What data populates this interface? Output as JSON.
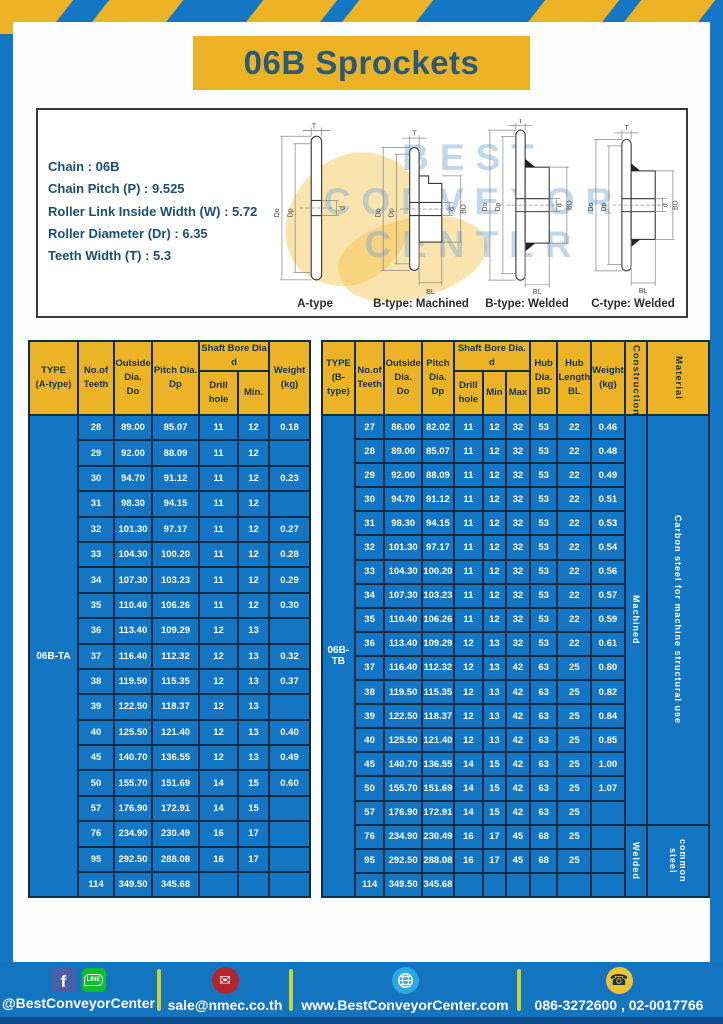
{
  "page": {
    "title": "06B Sprockets"
  },
  "specs": {
    "lines": [
      "Chain : 06B",
      "Chain Pitch (P) : 9.525",
      "Roller Link Inside Width (W) : 5.72",
      "Roller Diameter (Dr) : 6.35",
      "Teeth Width (T) : 5.3"
    ]
  },
  "watermark": {
    "line1": "BEST",
    "line2": "CONVEYOR",
    "line3": "CENTER"
  },
  "diagrams": {
    "figures": [
      {
        "caption": "A-type",
        "labels": {
          "t": "T",
          "do": "Do",
          "dp": "Dp",
          "d": "d"
        }
      },
      {
        "caption": "B-type: Machined",
        "labels": {
          "t": "T",
          "do": "Do",
          "dp": "Dp",
          "d": "d",
          "bd": "BD",
          "bl": "BL"
        }
      },
      {
        "caption": "B-type: Welded",
        "labels": {
          "t": "T",
          "do": "Do",
          "dp": "Dp",
          "d": "d",
          "bd": "BD",
          "bl": "BL"
        }
      },
      {
        "caption": "C-type: Welded",
        "labels": {
          "t": "T",
          "do": "Do",
          "dp": "Dp",
          "d": "d",
          "bd": "BD",
          "bl": "BL"
        }
      }
    ]
  },
  "table_a": {
    "type_label": "06B-TA",
    "headers": {
      "type": "TYPE\n(A-type)",
      "teeth": "No.of\nTeeth",
      "outside": "Outside\nDia.\nDo",
      "pitch": "Pitch Dia.\nDp",
      "shaft_group": "Shaft Bore Dia d",
      "drill": "Drill hole",
      "min": "Min.",
      "weight": "Weight\n(kg)"
    },
    "rows": [
      [
        "28",
        "89.00",
        "85.07",
        "11",
        "12",
        "0.18"
      ],
      [
        "29",
        "92.00",
        "88.09",
        "11",
        "12",
        ""
      ],
      [
        "30",
        "94.70",
        "91.12",
        "11",
        "12",
        "0.23"
      ],
      [
        "31",
        "98.30",
        "94.15",
        "11",
        "12",
        ""
      ],
      [
        "32",
        "101.30",
        "97.17",
        "11",
        "12",
        "0.27"
      ],
      [
        "33",
        "104.30",
        "100.20",
        "11",
        "12",
        "0.28"
      ],
      [
        "34",
        "107.30",
        "103.23",
        "11",
        "12",
        "0.29"
      ],
      [
        "35",
        "110.40",
        "106.26",
        "11",
        "12",
        "0.30"
      ],
      [
        "36",
        "113.40",
        "109.29",
        "12",
        "13",
        ""
      ],
      [
        "37",
        "116.40",
        "112.32",
        "12",
        "13",
        "0.32"
      ],
      [
        "38",
        "119.50",
        "115.35",
        "12",
        "13",
        "0.37"
      ],
      [
        "39",
        "122.50",
        "118.37",
        "12",
        "13",
        ""
      ],
      [
        "40",
        "125.50",
        "121.40",
        "12",
        "13",
        "0.40"
      ],
      [
        "45",
        "140.70",
        "136.55",
        "12",
        "13",
        "0.49"
      ],
      [
        "50",
        "155.70",
        "151.69",
        "14",
        "15",
        "0.60"
      ],
      [
        "57",
        "176.90",
        "172.91",
        "14",
        "15",
        ""
      ],
      [
        "76",
        "234.90",
        "230.49",
        "16",
        "17",
        ""
      ],
      [
        "95",
        "292.50",
        "288.08",
        "16",
        "17",
        ""
      ],
      [
        "114",
        "349.50",
        "345.68",
        "",
        "",
        ""
      ]
    ]
  },
  "table_b": {
    "type_label": "06B-TB",
    "headers": {
      "type": "TYPE\n(B-type)",
      "teeth": "No.of\nTeeth",
      "outside": "Outside\nDia.\nDo",
      "pitch": "Pitch\nDia.\nDp",
      "shaft_group": "Shaft Bore Dia. d",
      "drill": "Drill hole",
      "min": "Min",
      "max": "Max",
      "hub_dia": "Hub\nDia.\nBD",
      "hub_len": "Hub\nLength\nBL",
      "weight": "Weight\n(kg)",
      "construction": "Construction",
      "material": "Material"
    },
    "rows": [
      [
        "27",
        "86.00",
        "82.02",
        "11",
        "12",
        "32",
        "53",
        "22",
        "0.46"
      ],
      [
        "28",
        "89.00",
        "85.07",
        "11",
        "12",
        "32",
        "53",
        "22",
        "0.48"
      ],
      [
        "29",
        "92.00",
        "88.09",
        "11",
        "12",
        "32",
        "53",
        "22",
        "0.49"
      ],
      [
        "30",
        "94.70",
        "91.12",
        "11",
        "12",
        "32",
        "53",
        "22",
        "0.51"
      ],
      [
        "31",
        "98.30",
        "94.15",
        "11",
        "12",
        "32",
        "53",
        "22",
        "0.53"
      ],
      [
        "32",
        "101.30",
        "97.17",
        "11",
        "12",
        "32",
        "53",
        "22",
        "0.54"
      ],
      [
        "33",
        "104.30",
        "100.20",
        "11",
        "12",
        "32",
        "53",
        "22",
        "0.56"
      ],
      [
        "34",
        "107.30",
        "103.23",
        "11",
        "12",
        "32",
        "53",
        "22",
        "0.57"
      ],
      [
        "35",
        "110.40",
        "106.26",
        "11",
        "12",
        "32",
        "53",
        "22",
        "0.59"
      ],
      [
        "36",
        "113.40",
        "109.29",
        "12",
        "13",
        "32",
        "53",
        "22",
        "0.61"
      ],
      [
        "37",
        "116.40",
        "112.32",
        "12",
        "13",
        "42",
        "63",
        "25",
        "0.80"
      ],
      [
        "38",
        "119.50",
        "115.35",
        "12",
        "13",
        "42",
        "63",
        "25",
        "0.82"
      ],
      [
        "39",
        "122.50",
        "118.37",
        "12",
        "13",
        "42",
        "63",
        "25",
        "0.84"
      ],
      [
        "40",
        "125.50",
        "121.40",
        "12",
        "13",
        "42",
        "63",
        "25",
        "0.85"
      ],
      [
        "45",
        "140.70",
        "136.55",
        "14",
        "15",
        "42",
        "63",
        "25",
        "1.00"
      ],
      [
        "50",
        "155.70",
        "151.69",
        "14",
        "15",
        "42",
        "63",
        "25",
        "1.07"
      ],
      [
        "57",
        "176.90",
        "172.91",
        "14",
        "15",
        "42",
        "63",
        "25",
        ""
      ],
      [
        "76",
        "234.90",
        "230.49",
        "16",
        "17",
        "45",
        "68",
        "25",
        ""
      ],
      [
        "95",
        "292.50",
        "288.08",
        "16",
        "17",
        "45",
        "68",
        "25",
        ""
      ],
      [
        "114",
        "349.50",
        "345.68",
        "",
        "",
        "",
        "",
        "",
        ""
      ]
    ],
    "sections": [
      {
        "start": 0,
        "span": 17,
        "construction": "Machined",
        "material": "Carbon steel for machine structural use"
      },
      {
        "start": 17,
        "span": 3,
        "construction": "Welded",
        "material": "common steel"
      }
    ]
  },
  "footer": {
    "social_handle": "@BestConveyorCenter",
    "email": "sale@nmec.co.th",
    "website": "www.BestConveyorCenter.com",
    "phones": "086-3272600 , 02-0017766",
    "icons": {
      "facebook": "f",
      "line": "LINE",
      "mail": "✉",
      "phone": "☎"
    }
  },
  "colors": {
    "brand_blue": "#1377c5",
    "brand_yellow": "#edb327",
    "navy_text": "#14344f",
    "table_blue": "#1276c5",
    "title_text": "#2a5a78",
    "footer_strip": "#0d4c8c",
    "separator_green": "#c8d430",
    "facebook_blue": "#4a5fa5",
    "line_green": "#0bbf2e",
    "mail_red": "#b3242b",
    "globe_blue": "#2aa8df",
    "phone_yellow": "#eec437"
  }
}
